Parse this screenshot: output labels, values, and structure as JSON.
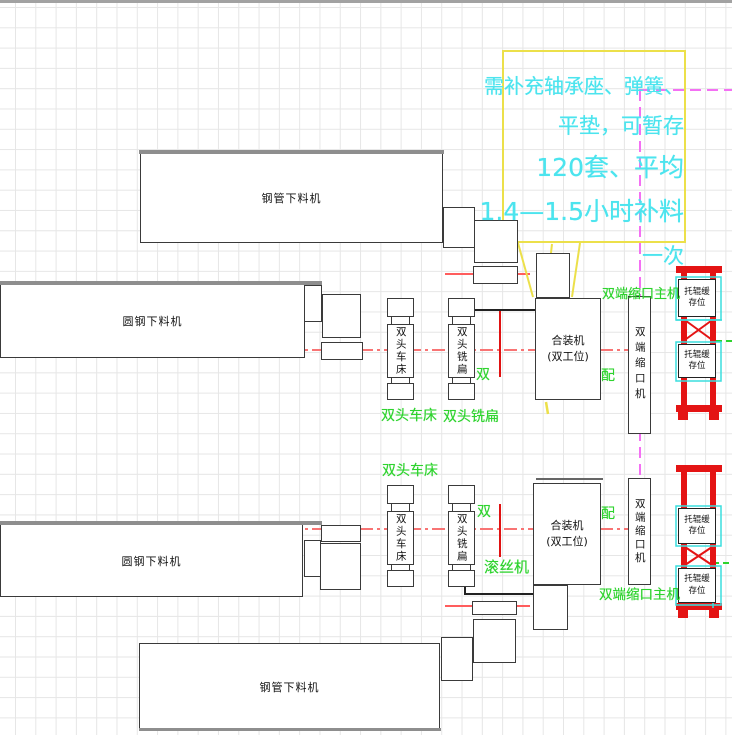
{
  "annotation": {
    "l1": "需补充轴承座、弹簧、",
    "l2": "平垫，可暂存",
    "l3": "120套、平均",
    "l4": "1.4—1.5小时补料",
    "l5": "一次"
  },
  "machines": {
    "pipe_cutter": "钢管下料机",
    "bar_cutter": "圆钢下料机",
    "lathe": "双头车床",
    "mill": "双头铣扁",
    "assembler_l1": "合装机",
    "assembler_l2": "(双工位)",
    "necking": "双端缩口机"
  },
  "green_labels": {
    "lathe": "双头车床",
    "mill": "双头铣扁",
    "thread_roller": "滚丝机",
    "necking_main": "双端缩口主机",
    "fragment_left": "双",
    "fragment_right": "配"
  },
  "rack": {
    "line1": "托辊缓",
    "line2": "存位"
  },
  "colors": {
    "cyan_text": "#4ce4ee",
    "green": "#2ed32e",
    "magenta": "#f470f4",
    "yellow": "#ece04a",
    "rack_red": "#e41414",
    "centerline_red": "#f87474"
  }
}
